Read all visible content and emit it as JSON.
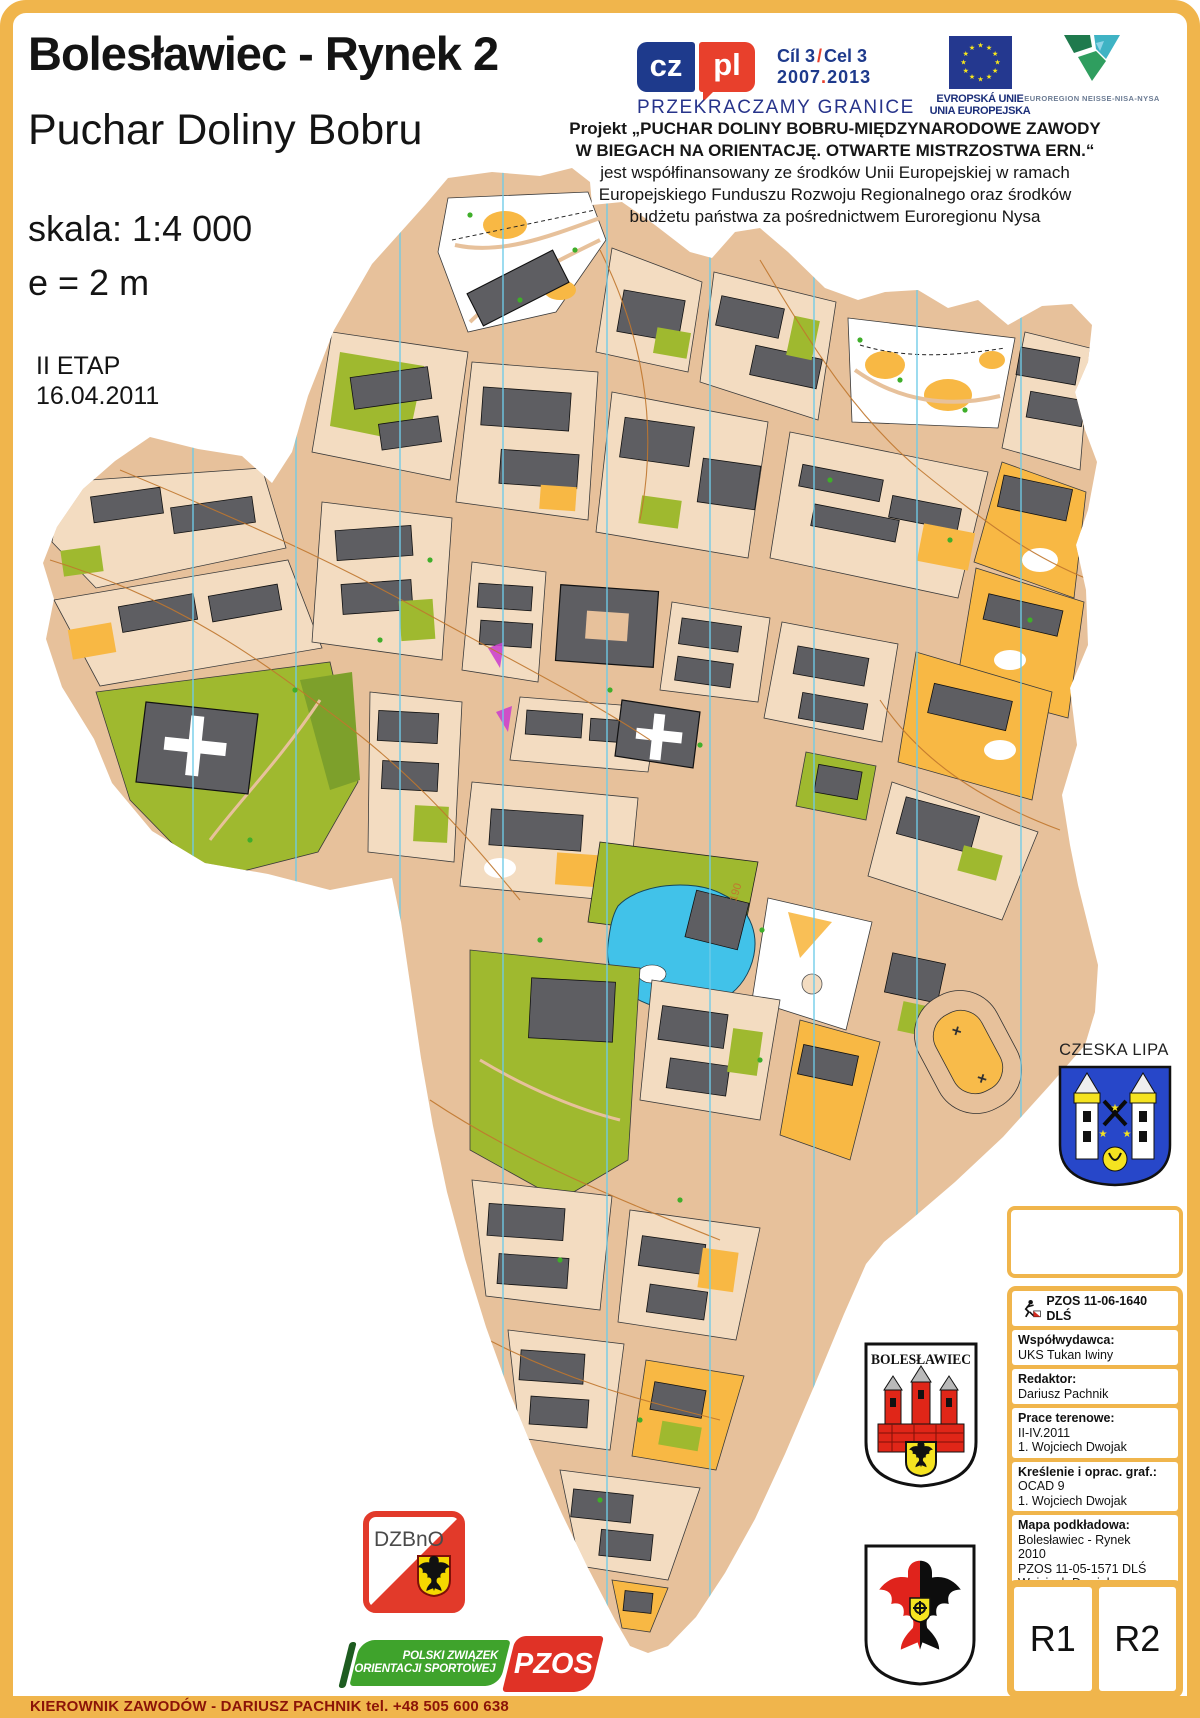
{
  "page": {
    "frame_color": "#f0b54c",
    "footer_text": "KIEROWNIK ZAWODÓW - DARIUSZ PACHNIK tel. +48 505 600 638"
  },
  "header": {
    "title": "Bolesławiec - Rynek 2",
    "subtitle": "Puchar Doliny Bobru",
    "scale": "skala: 1:4 000",
    "equidistance": "e = 2 m",
    "stage": "II ETAP",
    "date": "16.04.2011"
  },
  "logos": {
    "czpl": {
      "cz": "cz",
      "pl": "pl",
      "goal_left": "Cíl 3",
      "goal_sep": "/",
      "goal_right": "Cel 3",
      "years_left": "2007",
      "years_sep": ".",
      "years_right": "2013",
      "slogan": "PRZEKRACZAMY GRANICE"
    },
    "eu": {
      "line1": "EVROPSKÁ UNIE",
      "line2": "UNIA EUROPEJSKA"
    },
    "euroregion": {
      "label": "EUROREGION NEISSE-NISA-NYSA"
    }
  },
  "project_note": {
    "lines": [
      "Projekt „PUCHAR DOLINY BOBRU-MIĘDZYNARODOWE ZAWODY",
      "W BIEGACH NA ORIENTACJĘ. OTWARTE MISTRZOSTWA ERN.“",
      "jest współfinansowany ze środków Unii Europejskiej w ramach",
      "Europejskiego Funduszu Rozwoju Regionalnego oraz środków",
      "budżetu państwa za pośrednictwem Euroregionu Nysa"
    ]
  },
  "map": {
    "contour_label": "190",
    "colors": {
      "building": "#5e5e62",
      "road": "#e7c19b",
      "paved": "#f3dcc1",
      "open_orange": "#f8b844",
      "vegetation": "#9fb92f",
      "water": "#41c2e9",
      "north_line": "#6fcbe8",
      "contour": "#c0772e"
    }
  },
  "czeska_lipa": {
    "label": "CZESKA LIPA"
  },
  "boleslawiec_crest": {
    "label": "BOLESŁAWIEC"
  },
  "dzbno": {
    "label": "DZBnO"
  },
  "pzos": {
    "line1": "POLSKI ZWIĄZEK",
    "line2": "ORIENTACJI SPORTOWEJ",
    "abbr": "PZOS"
  },
  "info_panel": {
    "code": "PZOS 11-06-1640 DLŚ",
    "rows": [
      {
        "label": "Współwydawca:",
        "lines": [
          "UKS Tukan Iwiny"
        ]
      },
      {
        "label": "Redaktor:",
        "lines": [
          "Dariusz Pachnik"
        ]
      },
      {
        "label": "Prace terenowe:",
        "lines": [
          "II-IV.2011",
          "1. Wojciech Dwojak"
        ]
      },
      {
        "label": "Kreślenie i oprac. graf.:",
        "lines": [
          "OCAD 9",
          "1. Wojciech Dwojak"
        ]
      },
      {
        "label": "Mapa podkładowa:",
        "lines": [
          "Bolesławiec - Rynek",
          "2010",
          "PZOS 11-05-1571 DLŚ",
          "Wojciech Dwojak"
        ]
      }
    ],
    "routes": [
      "R1",
      "R2"
    ]
  }
}
